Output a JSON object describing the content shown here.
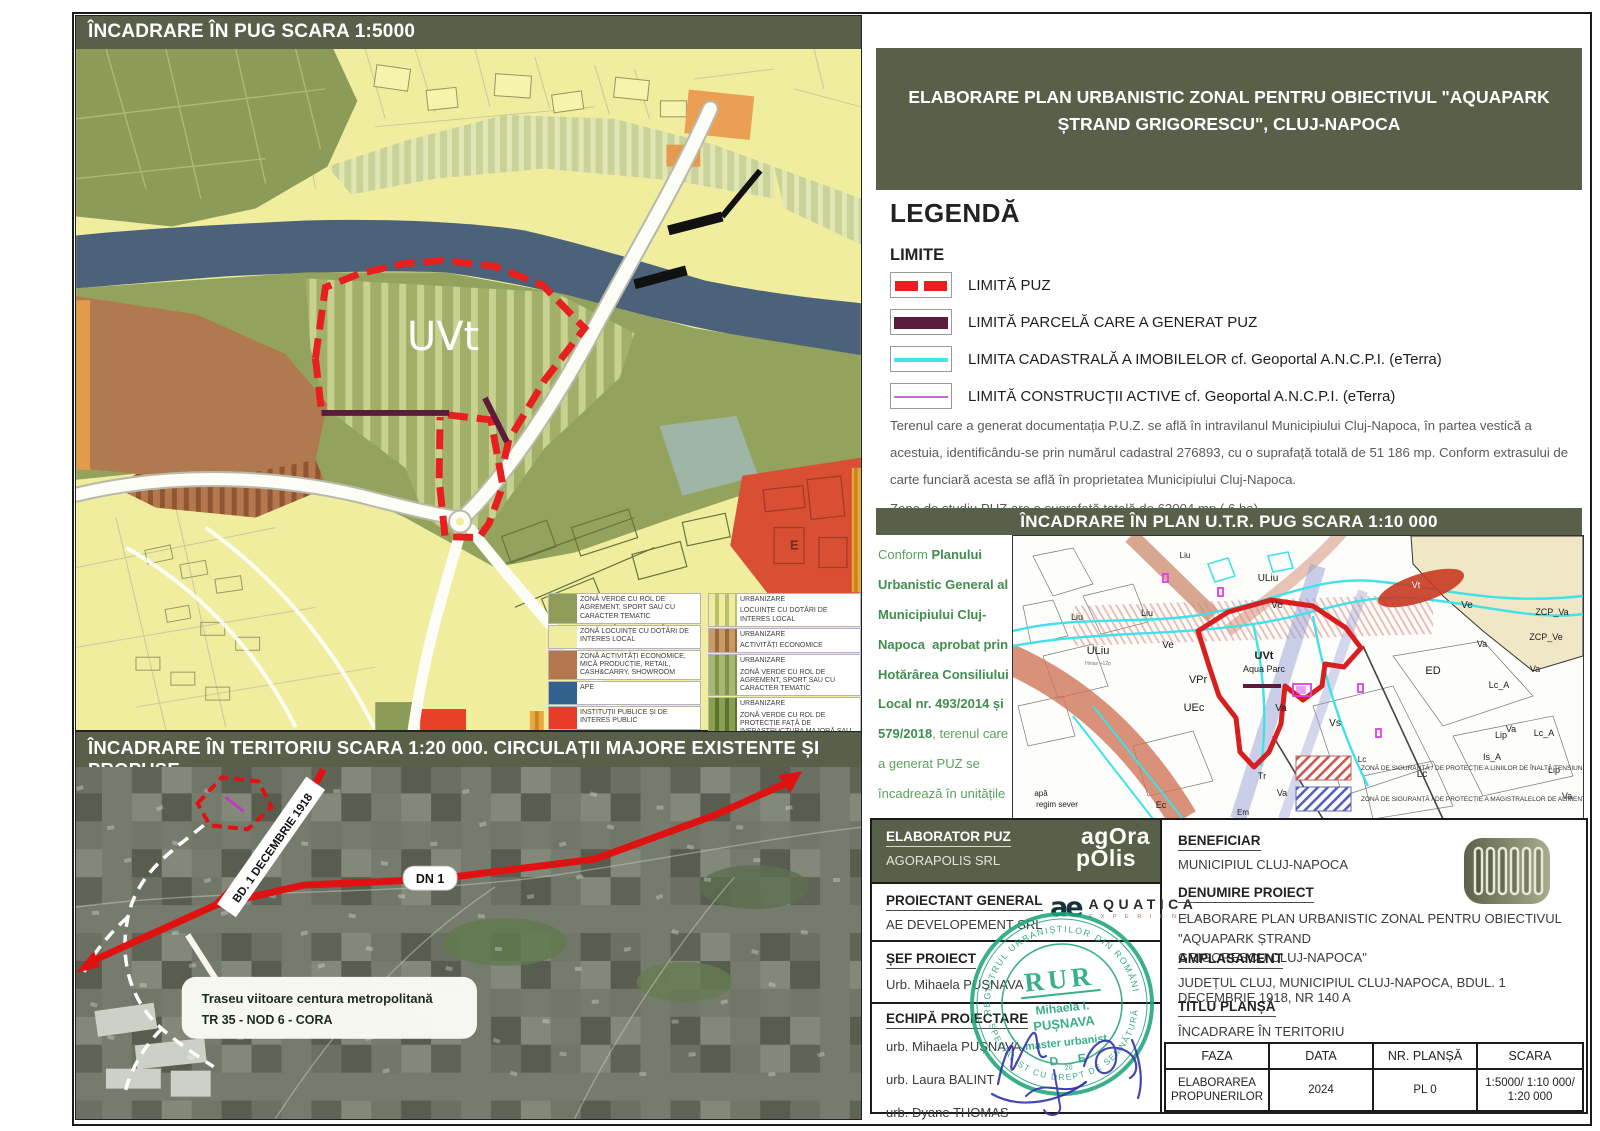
{
  "colors": {
    "header_bg": "#59604a",
    "puz_red": "#e81f1f",
    "parcel_maroon": "#5d1b3c",
    "cadastral_cyan": "#45e6ea",
    "constructii_violet": "#c070c8",
    "stamp_green": "#1ea47b"
  },
  "banner": {
    "line1": "ELABORARE PLAN URBANISTIC ZONAL PENTRU OBIECTIVUL \"AQUAPARK",
    "line2": "ȘTRAND GRIGORESCU\", CLUJ-NAPOCA"
  },
  "pug": {
    "header": "ÎNCADRARE ÎN PUG SCARA 1:5000",
    "site_label": "UVt",
    "e_label": "E",
    "mini_legend": {
      "solid": [
        {
          "c": "#8e9c58",
          "label": "ZONĂ VERDE CU ROL DE AGREMENT, SPORT SAU CU CARACTER TEMATIC"
        },
        {
          "c": "#efec9e",
          "label": "ZONĂ LOCUINȚE CU DOTĂRI DE INTERES LOCAL"
        },
        {
          "c": "#b5774d",
          "label": "ZONĂ ACTIVITĂȚI ECONOMICE, MICĂ PRODUCȚIE, RETAIL, CASH&CARRY, SHOWROOM"
        },
        {
          "c": "#33618e",
          "label": "APE"
        },
        {
          "c": "#e83c28",
          "label": "INSTITUȚII PUBLICE ȘI DE INTERES PUBLIC"
        }
      ],
      "striped": [
        {
          "base": "#efec9e",
          "stripe": "#b9c268",
          "title": "URBANIZARE",
          "label": "LOCUINȚE CU DOTĂRI DE INTERES LOCAL"
        },
        {
          "base": "#c89a66",
          "stripe": "#9a6a3a",
          "title": "URBANIZARE",
          "label": "ACTIVITĂȚI ECONOMICE"
        },
        {
          "base": "#a8b874",
          "stripe": "#7e9448",
          "title": "URBANIZARE",
          "label": "ZONĂ VERDE CU ROL DE AGREMENT, SPORT SAU CU CARACTER TEMATIC"
        },
        {
          "base": "#8aa04e",
          "stripe": "#5a7430",
          "title": "URBANIZARE",
          "label": "ZONĂ VERDE CU ROL DE PROTECȚIE FAȚĂ DE INFRASTRUCTURA MAJORĂ SAU CORIDOR ECOLOGIC"
        }
      ]
    }
  },
  "sat": {
    "header": "ÎNCADRARE ÎN TERITORIU SCARA 1:20 000. CIRCULAȚII MAJORE EXISTENTE ȘI PROPUSE",
    "bd_label": "BD. 1 DECEMBRIE 1918",
    "dn_label": "DN 1",
    "callout_line1": "Traseu viitoare centura metropolitană",
    "callout_line2": "TR 35 - NOD 6 - CORA"
  },
  "legend": {
    "title": "LEGENDĂ",
    "subtitle": "LIMITE",
    "items": [
      "LIMITĂ PUZ",
      "LIMITĂ PARCELĂ CARE A GENERAT PUZ",
      "LIMITA CADASTRALĂ A IMOBILELOR cf. Geoportal A.N.C.P.I. (eTerra)",
      "LIMITĂ CONSTRUCȚII ACTIVE cf. Geoportal A.N.C.P.I. (eTerra)"
    ],
    "paragraph1": "Terenul care a generat documentația P.U.Z. se află în intravilanul Municipiului Cluj-Napoca, în partea vestică a acestuia, identificându-se prin numărul cadastral 276893, cu o suprafață totală de 51 186 mp.  Conform extrasului de carte funciară acesta se află în proprietatea Municipiului Cluj-Napoca.",
    "paragraph2": "Zona de studiu PUZ are o suprafață totală de 63004 mp ( 6 ha)."
  },
  "utr": {
    "header": "ÎNCADRARE ÎN PLAN U.T.R. PUG SCARA 1:10 000",
    "conform_segments": [
      {
        "t": "Conform ",
        "b": false
      },
      {
        "t": "Planului Urbanistic General al Municipiului Cluj-Napoca  aprobat prin Hotărârea Consiliului Local nr. 493/2014 și 579/2018",
        "b": true
      },
      {
        "t": ", terenul care a generat PUZ se încadrează în unitățile teritoriale de referință:",
        "b": false
      },
      {
        "t": "\n - U.T.R.- UVt  - Zonă verde cu caracter tematic.",
        "b": true
      },
      {
        "t": "\n- U.T.R.- Ve  - Zonă verde de protecție a apelor sau cu rol de culoar ecologic .",
        "b": true
      }
    ],
    "map_labels": [
      {
        "t": "ULiu",
        "x": 85,
        "y": 118,
        "s": 11
      },
      {
        "t": "Hmax +12p",
        "x": 85,
        "y": 129,
        "s": 5,
        "c": "#777"
      },
      {
        "t": "Liu",
        "x": 64,
        "y": 84,
        "s": 9
      },
      {
        "t": "Liu",
        "x": 134,
        "y": 80,
        "s": 9
      },
      {
        "t": "ULiu",
        "x": 255,
        "y": 45,
        "s": 10
      },
      {
        "t": "Liu",
        "x": 172,
        "y": 22,
        "s": 8
      },
      {
        "t": "VPr",
        "x": 185,
        "y": 147,
        "s": 11
      },
      {
        "t": "UEc",
        "x": 181,
        "y": 175,
        "s": 11
      },
      {
        "t": "Ve",
        "x": 155,
        "y": 112,
        "s": 10
      },
      {
        "t": "Ve",
        "x": 264,
        "y": 72,
        "s": 10
      },
      {
        "t": "Ve",
        "x": 454,
        "y": 72,
        "s": 10
      },
      {
        "t": "Vt",
        "x": 403,
        "y": 52,
        "s": 9,
        "c": "#ffffff"
      },
      {
        "t": "UVt",
        "x": 251,
        "y": 123,
        "s": 11,
        "b": 1
      },
      {
        "t": "Aqua Parc",
        "x": 251,
        "y": 136,
        "s": 9
      },
      {
        "t": "Va",
        "x": 268,
        "y": 175,
        "s": 10
      },
      {
        "t": "Vs",
        "x": 322,
        "y": 190,
        "s": 10
      },
      {
        "t": "ED",
        "x": 420,
        "y": 138,
        "s": 11
      },
      {
        "t": "Lc_A",
        "x": 486,
        "y": 152,
        "s": 9
      },
      {
        "t": "Lc_A",
        "x": 531,
        "y": 200,
        "s": 9
      },
      {
        "t": "Lip",
        "x": 488,
        "y": 202,
        "s": 9
      },
      {
        "t": "Lip",
        "x": 541,
        "y": 237,
        "s": 9
      },
      {
        "t": "Is_A",
        "x": 479,
        "y": 224,
        "s": 9
      },
      {
        "t": "Lc",
        "x": 409,
        "y": 241,
        "s": 10
      },
      {
        "t": "Lc",
        "x": 349,
        "y": 226,
        "s": 8
      },
      {
        "t": "ZCP_Va",
        "x": 539,
        "y": 79,
        "s": 9
      },
      {
        "t": "ZCP_Ve",
        "x": 533,
        "y": 104,
        "s": 9
      },
      {
        "t": "Tr",
        "x": 249,
        "y": 243,
        "s": 9
      },
      {
        "t": "Va",
        "x": 269,
        "y": 260,
        "s": 9
      },
      {
        "t": "Ec",
        "x": 148,
        "y": 272,
        "s": 9
      },
      {
        "t": "Em",
        "x": 230,
        "y": 279,
        "s": 8
      },
      {
        "t": "apă",
        "x": 28,
        "y": 260,
        "s": 8
      },
      {
        "t": "regim sever",
        "x": 44,
        "y": 271,
        "s": 8
      },
      {
        "t": "Va",
        "x": 498,
        "y": 196,
        "s": 9
      },
      {
        "t": "Va",
        "x": 522,
        "y": 136,
        "s": 9
      },
      {
        "t": "Va",
        "x": 469,
        "y": 111,
        "s": 9
      },
      {
        "t": "Va",
        "x": 554,
        "y": 263,
        "s": 9
      }
    ],
    "legend": [
      {
        "label": "ZONĂ DE SIGURANȚĂ / DE PROTECȚIE A LINIILOR DE ÎNALTĂ TENSIUNE",
        "type": "red"
      },
      {
        "label": "ZONĂ DE SIGURANȚĂ / DE PROTECȚIE A MAGISTRALELOR DE ALIMENTARE CU APĂ",
        "type": "blue"
      }
    ]
  },
  "titleblock": {
    "elaborator": {
      "label": "ELABORATOR PUZ",
      "value": "AGORAPOLIS SRL",
      "logo_line1": "agOra",
      "logo_line2": "pOlis"
    },
    "proiectant": {
      "label": "PROIECTANT GENERAL",
      "value": "AE DEVELOPEMENT SRL",
      "logo_mark": "ae",
      "logo_name": "AQUATICA",
      "logo_sub": "E X P E R I E N C E"
    },
    "sef": {
      "label": "ȘEF PROIECT",
      "value": "Urb. Mihaela PUȘNAVA"
    },
    "echipa": {
      "label": "ECHIPĂ PROIECTARE",
      "members": [
        "urb. Mihaela PUȘNAVA",
        "urb. Laura BALINT",
        "urb. Dyane THOMAS"
      ]
    },
    "beneficiar": {
      "label": "BENEFICIAR",
      "value": "MUNICIPIUL CLUJ-NAPOCA"
    },
    "denumire": {
      "label": "DENUMIRE PROIECT",
      "value1": "ELABORARE PLAN URBANISTIC ZONAL PENTRU OBIECTIVUL  \"AQUAPARK ȘTRAND",
      "value2": "GRIGORESCU CLUJ-NAPOCA\""
    },
    "amplasament": {
      "label": "AMPLASAMENT",
      "value": "JUDEȚUL CLUJ, MUNICIPIUL CLUJ-NAPOCA, BDUL. 1 DECEMBRIE 1918, NR 140 A"
    },
    "titlu": {
      "label": "TITLU PLANȘĂ",
      "value": "ÎNCADRARE ÎN TERITORIU"
    },
    "stamp": {
      "big": "RUR",
      "name1": "Mihaela I.",
      "name2": "PUȘNAVA",
      "role": "master urbanist",
      "d": "D",
      "e": "E",
      "num": "20",
      "ring_top": "✦ REGISTRUL URBANIȘTILOR DIN ROMÂNIA ✦",
      "ring_bottom": "SPECIALIST CU DREPT DE SEMNĂTURĂ"
    },
    "table": {
      "headers": [
        "FAZA",
        "DATA",
        "NR. PLANȘĂ",
        "SCARA"
      ],
      "values": [
        "ELABORAREA\nPROPUNERILOR",
        "2024",
        "PL 0",
        "1:5000/ 1:10 000/\n1:20 000"
      ]
    }
  }
}
